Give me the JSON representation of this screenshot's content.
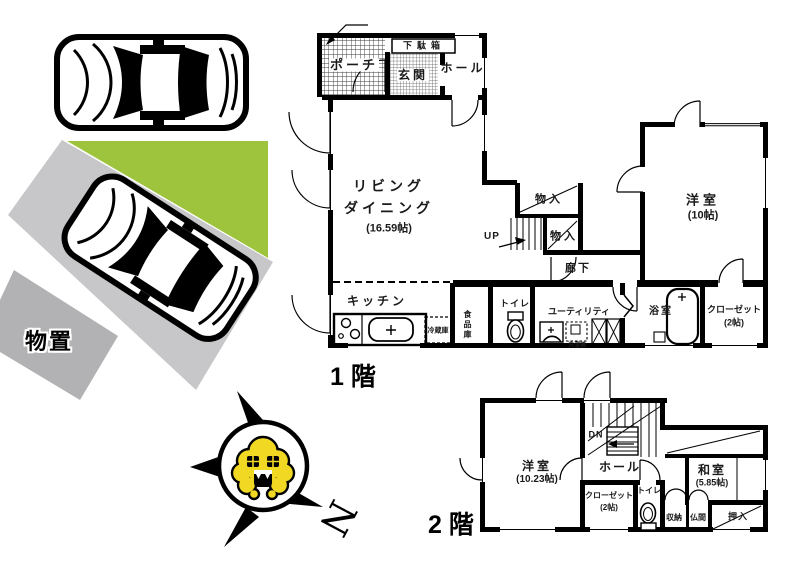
{
  "colors": {
    "green": "#9ec43e",
    "driveway": "#c7c7c9",
    "driveway_dark": "#b2b2b4",
    "mascot_yellow": "#f0d823",
    "wall": "#000000"
  },
  "site": {
    "shed_label": "物置",
    "compass_north": "N"
  },
  "floor1": {
    "name": "1階",
    "porch": "ポーチ",
    "shoe_cabinet": "下駄箱",
    "entrance": "玄関",
    "hall": "ホール",
    "living_line1": "リビング",
    "living_line2": "ダイニング",
    "living_size": "(16.59帖)",
    "closet_a": "物入",
    "closet_b": "物入",
    "stairs_up": "UP",
    "corridor": "廊下",
    "western_room": "洋室",
    "western_room_size": "(10帖)",
    "kitchen": "キッチン",
    "fridge": "冷蔵庫",
    "pantry": "食品庫",
    "toilet": "トイレ",
    "utility": "ユーティリティ",
    "washer": "洗濯機",
    "bath": "浴室",
    "closet": "クローゼット",
    "closet_size": "(2帖)"
  },
  "floor2": {
    "name": "2階",
    "stairs_down": "DN",
    "western_room": "洋室",
    "western_room_size": "(10.23帖)",
    "hall": "ホール",
    "closet": "クローゼット",
    "closet_size": "(2帖)",
    "toilet": "トイレ",
    "japanese_room": "和室",
    "japanese_room_size": "(5.85帖)",
    "storage": "収納",
    "butsuma": "仏間",
    "oshiire": "押入"
  }
}
